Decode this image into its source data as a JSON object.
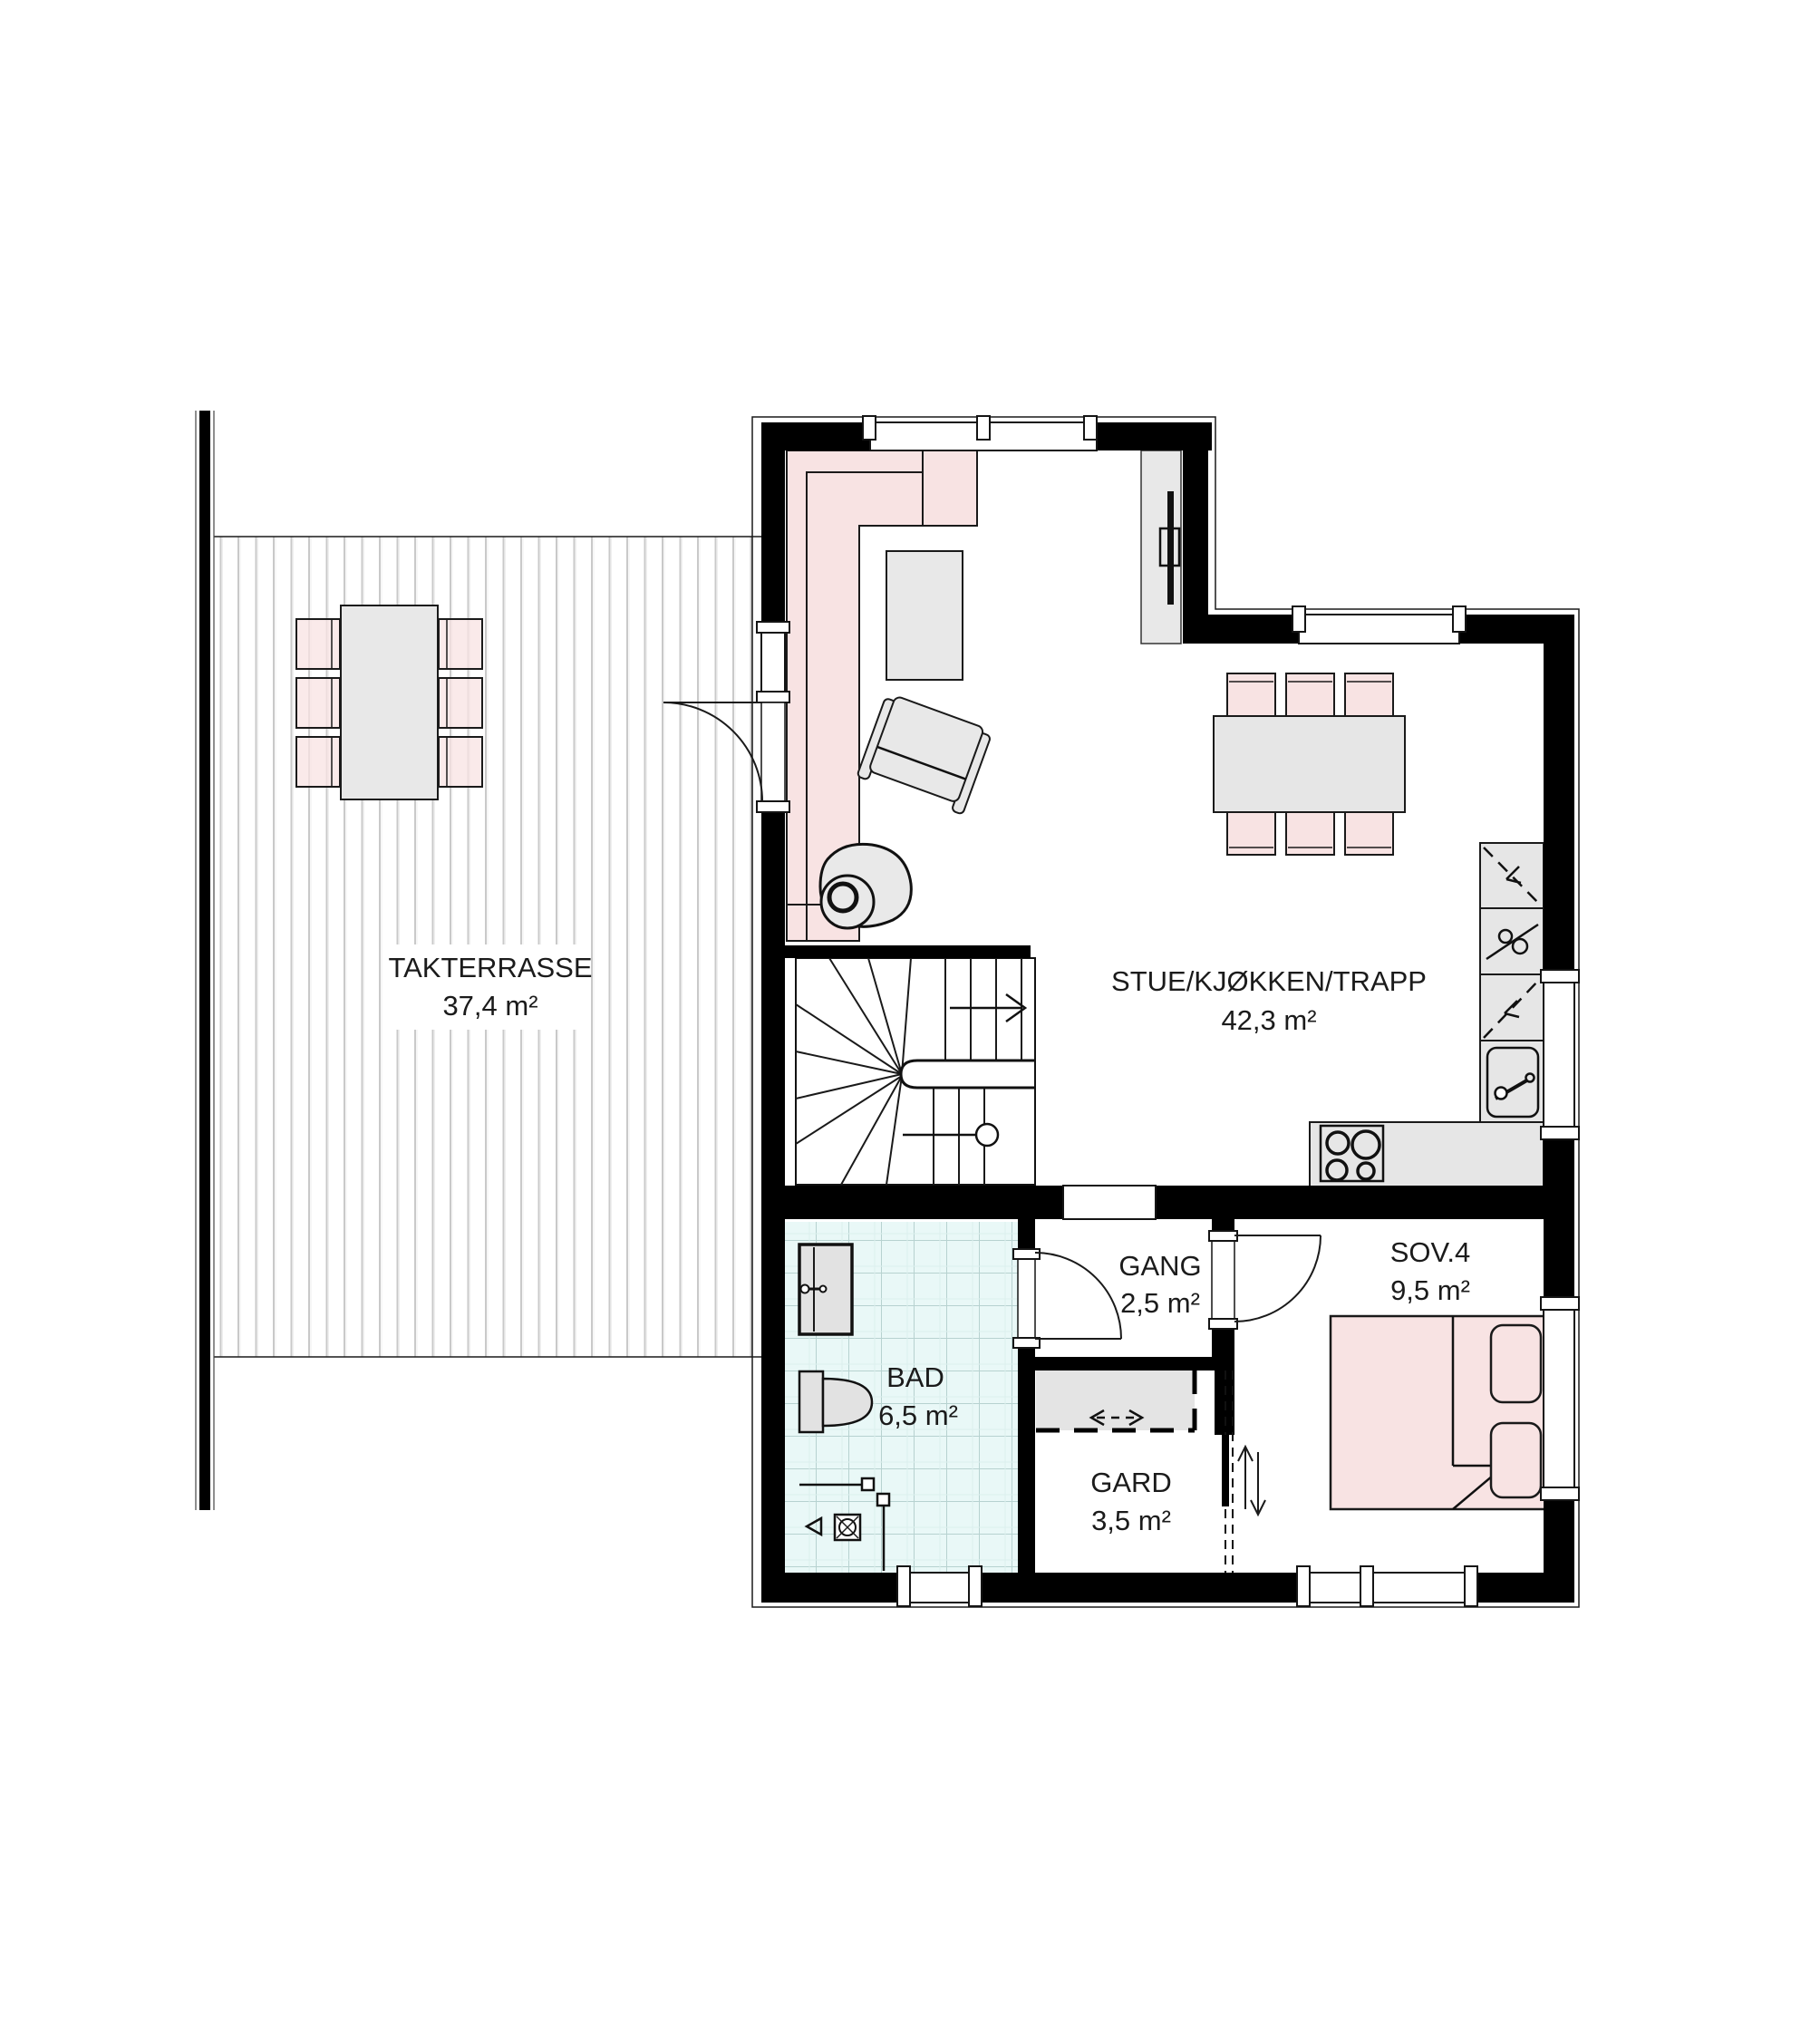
{
  "plan": {
    "type": "floor-plan",
    "rooms": [
      {
        "key": "takterrasse",
        "name": "TAKTERRASSE",
        "area": "37,4 m²"
      },
      {
        "key": "stue-kjokken-trapp",
        "name": "STUE/KJØKKEN/TRAPP",
        "area": "42,3 m²"
      },
      {
        "key": "gang",
        "name": "GANG",
        "area": "2,5 m²"
      },
      {
        "key": "sov4",
        "name": "SOV.4",
        "area": "9,5 m²"
      },
      {
        "key": "bad",
        "name": "BAD",
        "area": "6,5 m²"
      },
      {
        "key": "gard",
        "name": "GARD",
        "area": "3,5 m²"
      }
    ],
    "colors": {
      "wall": "#000000",
      "furniture_pink": "#f8e3e3",
      "furniture_gray": "#e8e8e8",
      "bath_tile": "#e9f8f7",
      "tile_grid": "#b7d2d0",
      "deck_line": "#c9c9c9",
      "closet_gray": "#e4e4e4",
      "text": "#1b1b1b"
    },
    "fixtures": [
      "stairs",
      "kitchen-counter",
      "sink",
      "stove",
      "tall-cabinets",
      "dining-table",
      "chairs",
      "corner-sofa",
      "coffee-table",
      "armchair",
      "hanging-chair",
      "tv",
      "bed",
      "pillows",
      "wardrobe-closet",
      "sliding-door",
      "toilet",
      "washbasin",
      "shower",
      "terrace-table"
    ]
  }
}
